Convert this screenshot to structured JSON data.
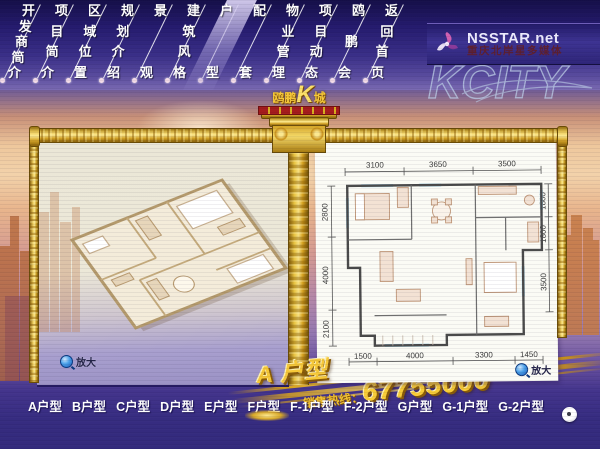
{
  "top_nav": {
    "items": [
      {
        "label": "开发商简介",
        "active": false
      },
      {
        "label": "项目简介",
        "active": false
      },
      {
        "label": "区域位置",
        "active": false
      },
      {
        "label": "规划介绍",
        "active": false
      },
      {
        "label": "景观",
        "active": false
      },
      {
        "label": "建筑风格",
        "active": false
      },
      {
        "label": "户型",
        "active": true
      },
      {
        "label": "配套",
        "active": false
      },
      {
        "label": "物业管理",
        "active": false
      },
      {
        "label": "项目动态",
        "active": false
      },
      {
        "label": "鸥鹏会",
        "active": false
      },
      {
        "label": "返回首页",
        "active": false
      }
    ]
  },
  "brand_logo": {
    "prefix": "鸥鹏",
    "k": "K",
    "suffix": "城"
  },
  "nsstar": {
    "name": "NSSTAR.net",
    "subtitle": "重庆北岸星多媒体"
  },
  "kcity_watermark": "KCITY",
  "floorplan_2d": {
    "dims_top": [
      "3100",
      "3650",
      "3500"
    ],
    "dims_left": [
      "2800",
      "4000",
      "2100"
    ],
    "dims_right": [
      "1800",
      "1800",
      "3500"
    ],
    "dims_bottom": [
      "1500",
      "4000",
      "3300",
      "1450"
    ]
  },
  "zoom_left_label": "放大",
  "zoom_right_label": "放大",
  "unit_title": "A 户型",
  "hotline": {
    "label": "销售热线：",
    "number": "67755000"
  },
  "bottom_nav": {
    "items": [
      {
        "label": "A户型",
        "highlight": false
      },
      {
        "label": "B户型",
        "highlight": false
      },
      {
        "label": "C户型",
        "highlight": false
      },
      {
        "label": "D户型",
        "highlight": false
      },
      {
        "label": "E户型",
        "highlight": false
      },
      {
        "label": "F户型",
        "highlight": true
      },
      {
        "label": "F-1户型",
        "highlight": false
      },
      {
        "label": "F-2户型",
        "highlight": false
      },
      {
        "label": "G户型",
        "highlight": false
      },
      {
        "label": "G-1户型",
        "highlight": false
      },
      {
        "label": "G-2户型",
        "highlight": false
      }
    ]
  },
  "colors": {
    "gold": "#e8c23a",
    "purple_bg": "#342a7c",
    "nav_bg": "#251b6e",
    "ribbon_red": "#a51c1c"
  }
}
